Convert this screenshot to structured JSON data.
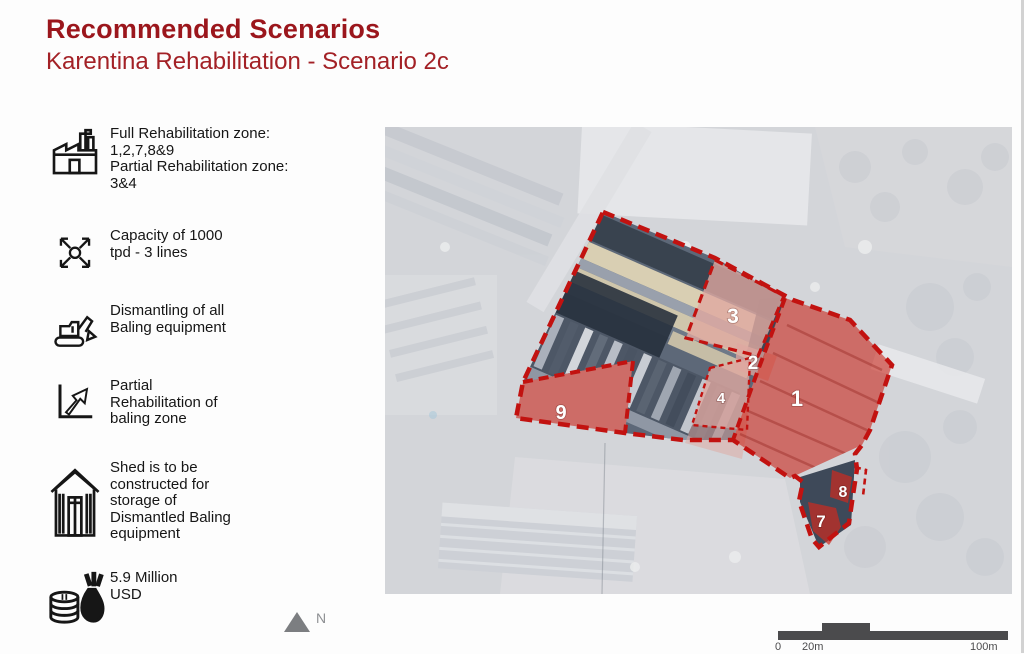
{
  "header": {
    "title": "Recommended Scenarios",
    "subtitle": "Karentina Rehabilitation - Scenario 2c",
    "colors": {
      "title": "#9b161c",
      "subtitle": "#a32126"
    }
  },
  "sidebar": {
    "items": [
      {
        "icon": "factory-icon",
        "lines": [
          "Full Rehabilitation zone:",
          "1,2,7,8&9",
          "Partial Rehabilitation zone:",
          "3&4"
        ]
      },
      {
        "icon": "capacity-arrows-icon",
        "lines": [
          "Capacity of 1000",
          "tpd - 3 lines"
        ]
      },
      {
        "icon": "excavator-icon",
        "lines": [
          "Dismantling of all",
          "Baling equipment"
        ]
      },
      {
        "icon": "partial-rehabilitation-icon",
        "lines": [
          "Partial",
          "Rehabilitation of",
          "baling zone"
        ]
      },
      {
        "icon": "shed-icon",
        "lines": [
          "Shed is to be",
          "constructed for",
          "storage of",
          "Dismantled Baling",
          "equipment"
        ]
      },
      {
        "icon": "money-icon",
        "lines": [
          "5.9 Million",
          "USD"
        ]
      }
    ]
  },
  "map": {
    "zone_labels": {
      "z1": "1",
      "z2": "2",
      "z3": "3",
      "z4": "4",
      "z7": "7",
      "z8": "8",
      "z9": "9"
    },
    "north_label": "N",
    "scale_labels": {
      "zero": "0",
      "twenty": "20m",
      "hundred": "100m"
    },
    "colors": {
      "zone_full": "#c92b20",
      "zone_partial": "#dfa7a0",
      "boundary": "#c21210"
    }
  }
}
